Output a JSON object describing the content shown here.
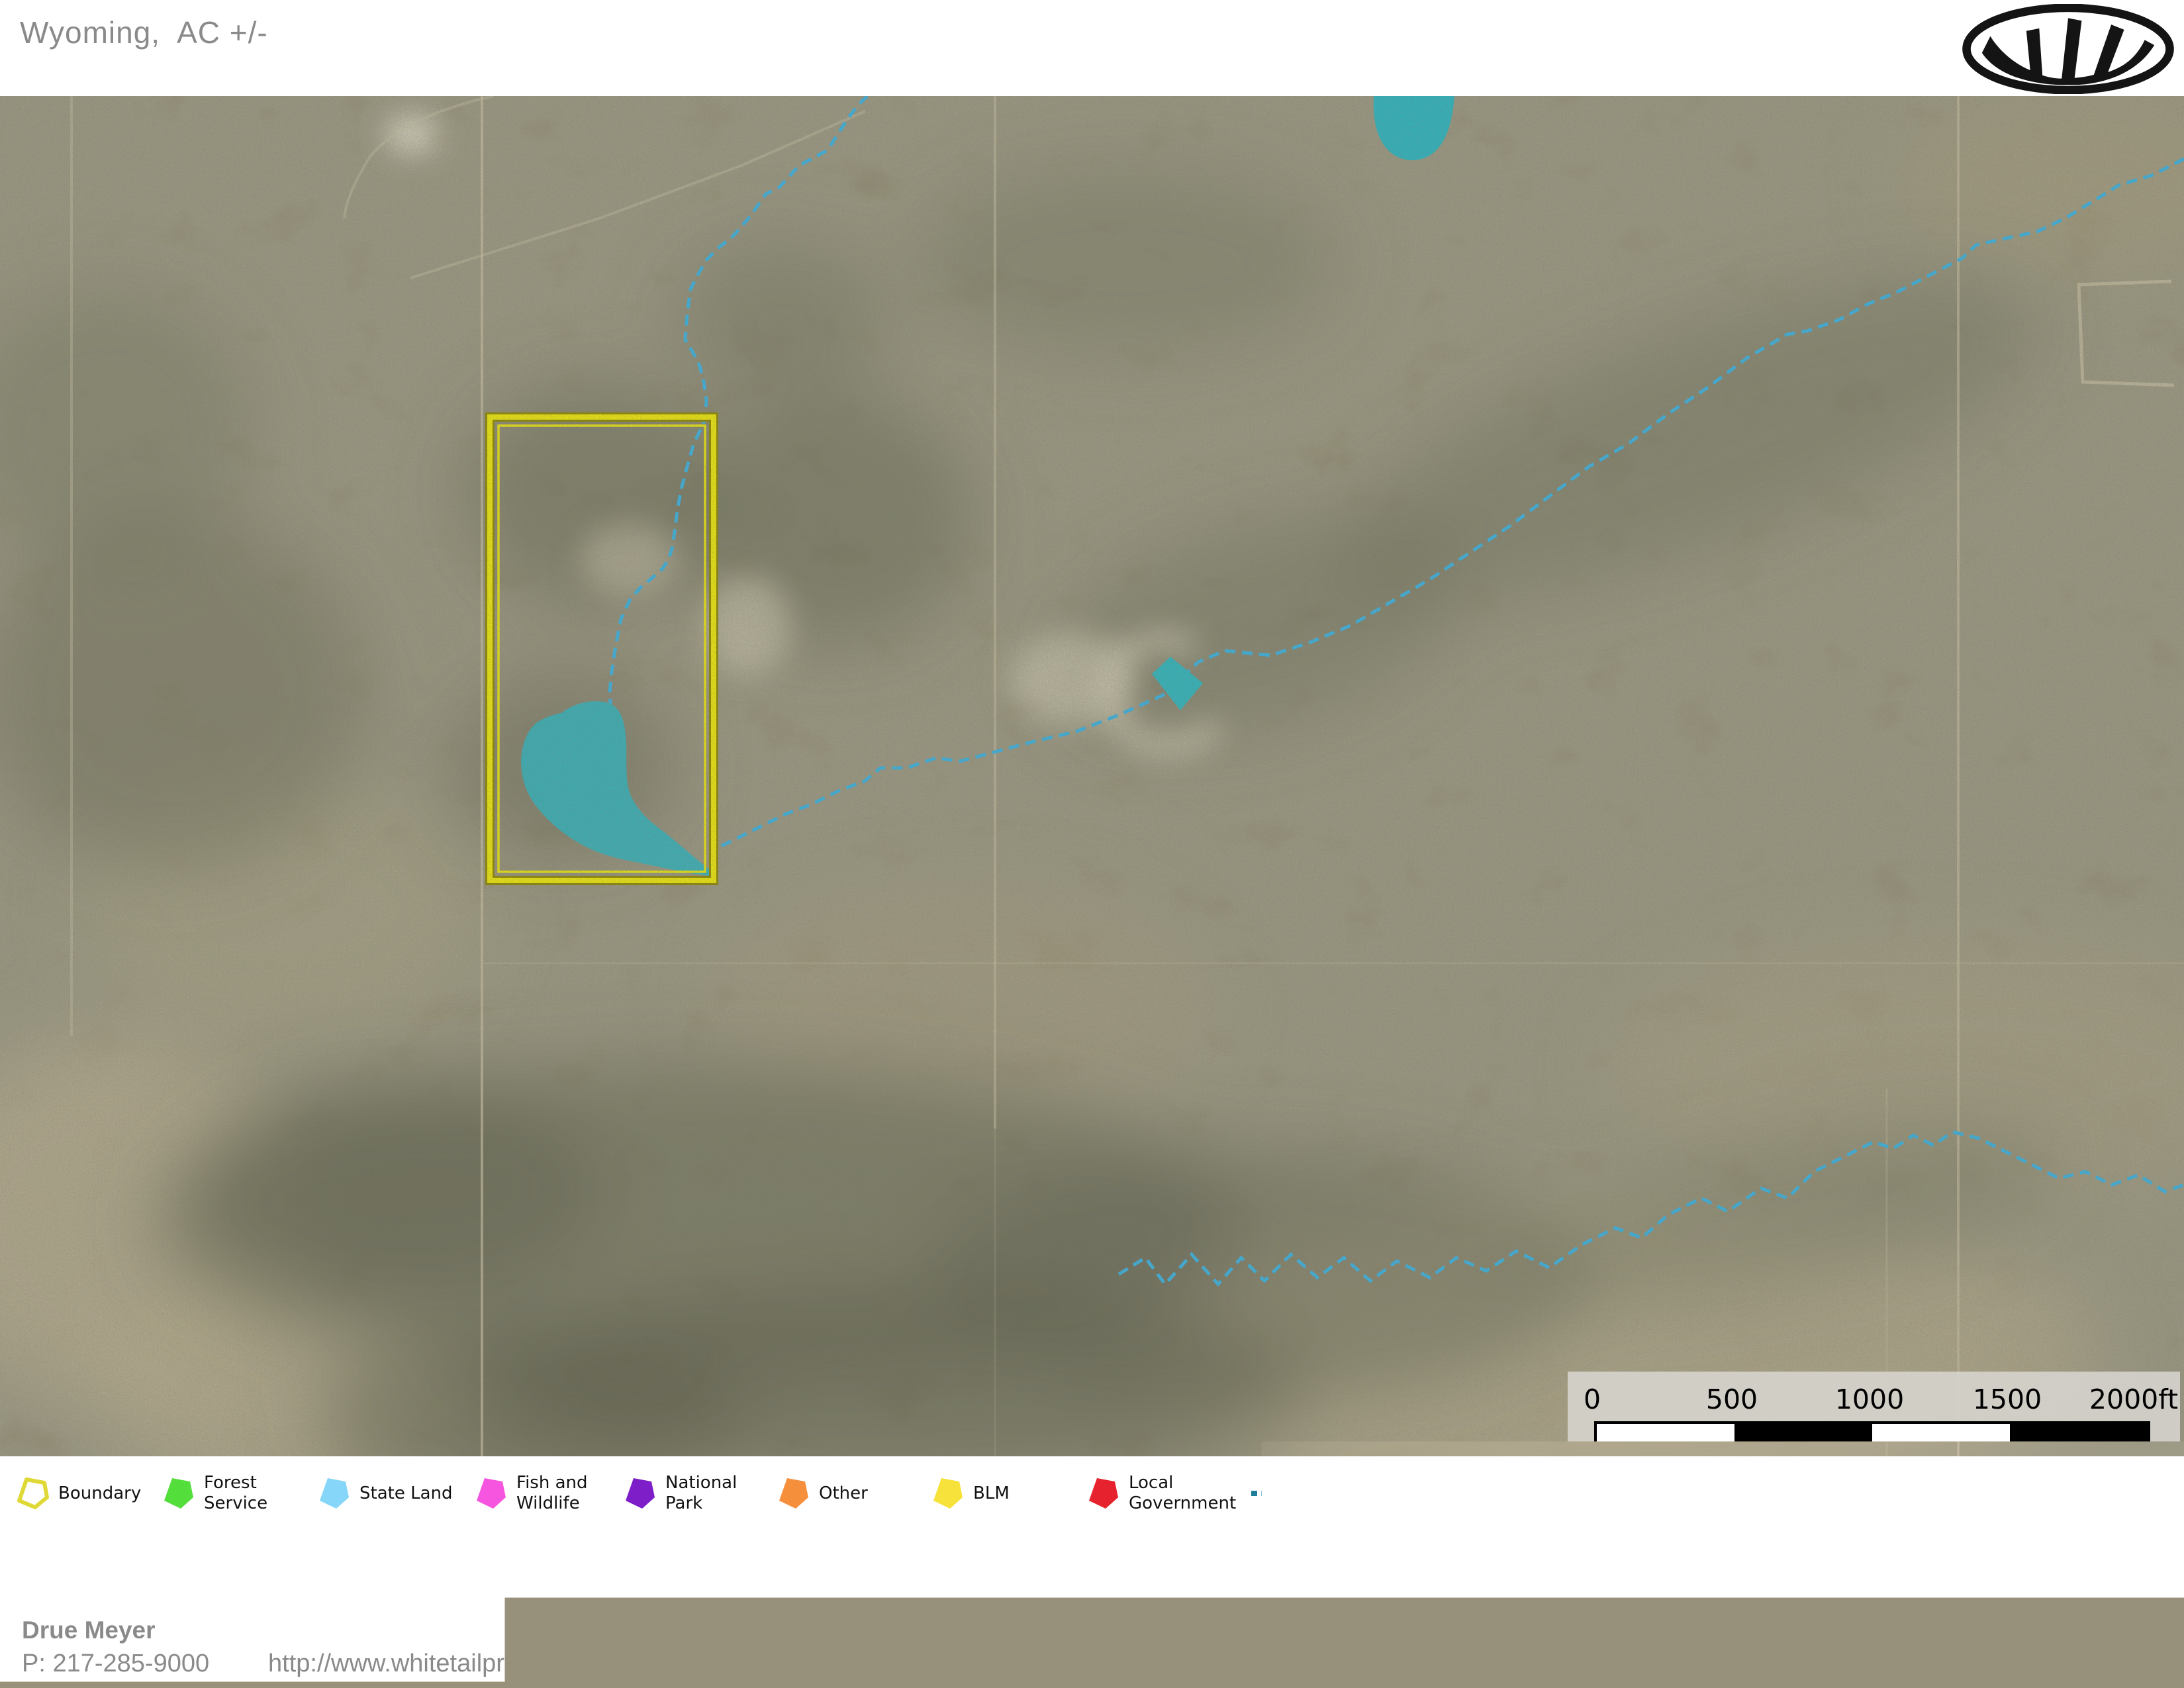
{
  "header": {
    "title": "Wyoming,  AC +/-"
  },
  "map": {
    "scale_bar": {
      "labels": [
        "0",
        "500",
        "1000",
        "1500",
        "2000ft"
      ]
    }
  },
  "legend": {
    "items": [
      {
        "label": "Boundary",
        "color": "#DFD937",
        "type": "polygon-outline"
      },
      {
        "label": "Forest\nService",
        "color": "#54DE3B",
        "type": "polygon"
      },
      {
        "label": "State Land",
        "color": "#85D6F8",
        "type": "polygon"
      },
      {
        "label": "Fish and\nWildlife",
        "color": "#F655DF",
        "type": "polygon"
      },
      {
        "label": "National\nPark",
        "color": "#7D1EC8",
        "type": "polygon"
      },
      {
        "label": "Other",
        "color": "#F68F3C",
        "type": "polygon"
      },
      {
        "label": "BLM",
        "color": "#F6E23A",
        "type": "polygon"
      },
      {
        "label": "Local\nGovernment",
        "color": "#E6222E",
        "type": "polygon"
      },
      {
        "label": "Stream,\nIntermittent",
        "color": "#1D7F9C",
        "type": "dashed-line"
      },
      {
        "label": "River/Creek",
        "color": "#1D7F9C",
        "type": "solid-line"
      },
      {
        "label": "Water Body",
        "color": "#19768E",
        "type": "polygon"
      }
    ]
  },
  "footer": {
    "agent_name": "Drue Meyer",
    "phone": "P: 217-285-9000",
    "website": "http://www.whitetailproperties.com",
    "logo_letter": "M",
    "disclaimer_line1": "The information contained herein was obtained from sources deemed to be reliable.",
    "disclaimer_line2": " MapRight Services makes no warranties or guarantees as to the completeness or accuracy thereof."
  },
  "colors": {
    "boundary_yellow": "#F2EC0A",
    "boundary_edge": "#8F8800",
    "water_teal": "#34B4C0",
    "stream_blue": "#3AB5E8",
    "mapright_green": "#79B344"
  }
}
